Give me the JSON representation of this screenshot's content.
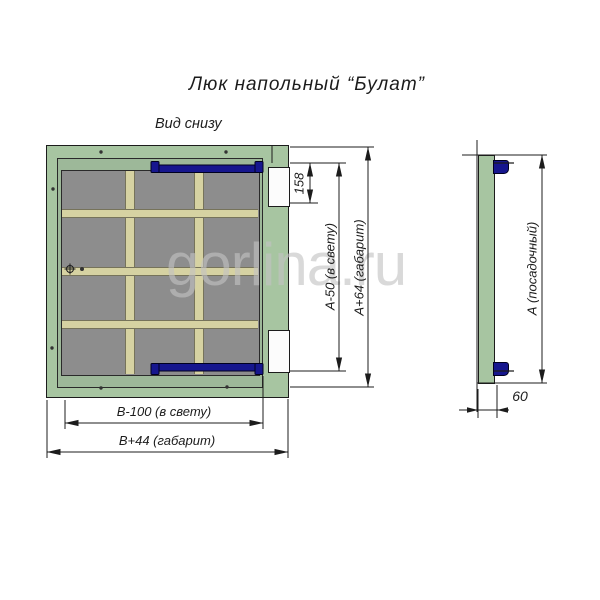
{
  "title": "Люк напольный “Булат”",
  "view_label": "Вид снизу",
  "watermark": "gorlina.ru",
  "dimensions": {
    "hinge_spacing": "158",
    "clear_height": "А-50 (в свету)",
    "overall_height": "А+64 (габарит)",
    "clear_width": "В-100 (в свету)",
    "overall_width": "В+44 (габарит)",
    "seating_height": "А (посадочный)",
    "depth": "60"
  },
  "colors": {
    "frame_green": "#a7c5a1",
    "lid_green": "#9db899",
    "panel_gray": "#8d8d8d",
    "rib_cream": "#d6d2a2",
    "handle_blue": "#16168e",
    "line_dark": "#1c1c1c",
    "watermark_gray": "#c3c3c3"
  }
}
